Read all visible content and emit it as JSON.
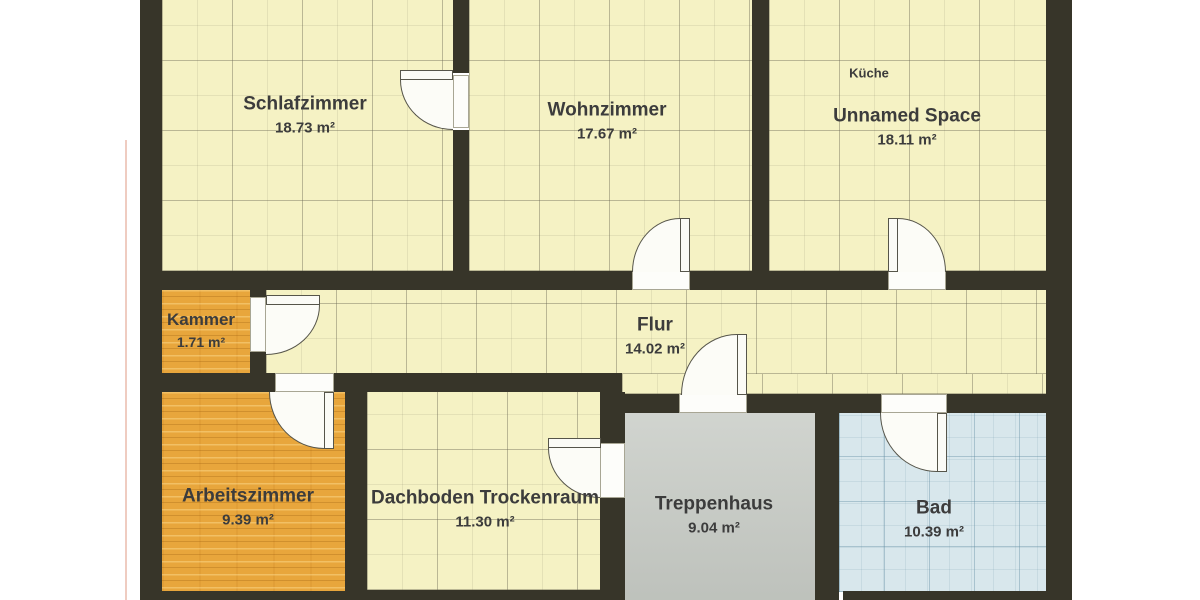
{
  "document": {
    "type": "floor-plan-scan",
    "language": "de"
  },
  "colors": {
    "wall": "#373529",
    "floor_yellow_tile": "#f5f2c4",
    "floor_wood": "#e8a63c",
    "floor_gray": "#c8ccc6",
    "floor_blue_tile": "#d8e7ec",
    "door_symbol": "#fcfcf7",
    "label_text": "#3c3c3c",
    "page_margin": "#ffffff"
  },
  "rooms": [
    {
      "id": "schlafzimmer",
      "name": "Schlafzimmer",
      "area": "18.73 m²",
      "floor": "yellow-tile"
    },
    {
      "id": "wohnzimmer",
      "name": "Wohnzimmer",
      "area": "17.67 m²",
      "floor": "yellow-tile"
    },
    {
      "id": "kueche",
      "tag": "Küche",
      "name": "Unnamed Space",
      "area": "18.11 m²",
      "floor": "yellow-tile"
    },
    {
      "id": "kammer",
      "name": "Kammer",
      "area": "1.71 m²",
      "floor": "wood"
    },
    {
      "id": "flur",
      "name": "Flur",
      "area": "14.02 m²",
      "floor": "yellow-tile"
    },
    {
      "id": "arbeitszimmer",
      "name": "Arbeitszimmer",
      "area": "9.39 m²",
      "floor": "wood"
    },
    {
      "id": "dachboden",
      "name": "Dachboden Trockenraum",
      "area": "11.30 m²",
      "floor": "yellow-tile"
    },
    {
      "id": "treppenhaus",
      "name": "Treppenhaus",
      "area": "9.04 m²",
      "floor": "gray"
    },
    {
      "id": "bad",
      "name": "Bad",
      "area": "10.39 m²",
      "floor": "blue-tile"
    }
  ]
}
